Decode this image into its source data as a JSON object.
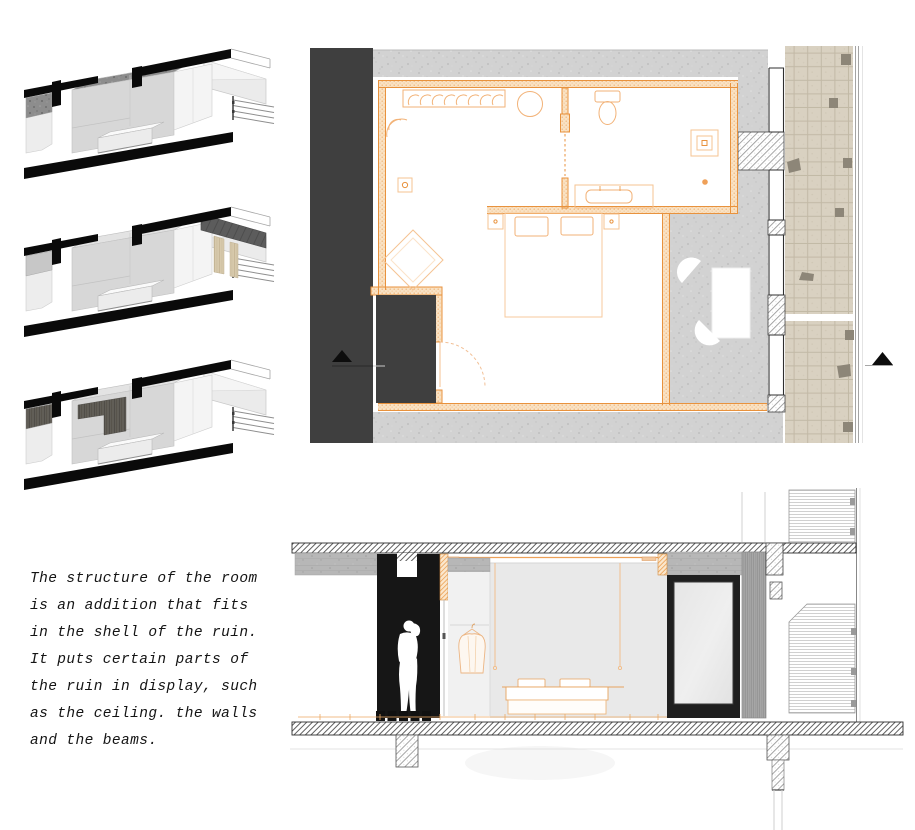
{
  "sheet": {
    "kind": "architecture-presentation-page",
    "background": "#ffffff"
  },
  "caption": {
    "text": "The structure of the room\nis an addition that fits\nin the shell of the ruin.\nIt puts certain parts of\nthe ruin in display, such\nas the ceiling. the walls\nand the beams."
  },
  "figures": {
    "axonometric_sections": [
      {
        "name": "axon-section-ceiling-exposed"
      },
      {
        "name": "axon-section-walls-exposed"
      },
      {
        "name": "axon-section-beams-exposed"
      }
    ],
    "floor_plan": {
      "name": "room-floor-plan"
    },
    "building_section": {
      "name": "room-long-section"
    }
  },
  "icons": {
    "section_marker_left": "filled-triangle-up",
    "section_marker_right": "filled-triangle-up",
    "person": "human-silhouette",
    "door_swing": "quarter-arc-dashed"
  },
  "colors": {
    "accent_orange": "#E8923D",
    "light_orange": "#F2B277",
    "dark_panel": "#3F3F3F",
    "portal_black": "#161616",
    "concrete_gray": "#D2D2D2",
    "brick_beige": "#D9D1C1",
    "wall_fill": "#F9E2C4"
  }
}
